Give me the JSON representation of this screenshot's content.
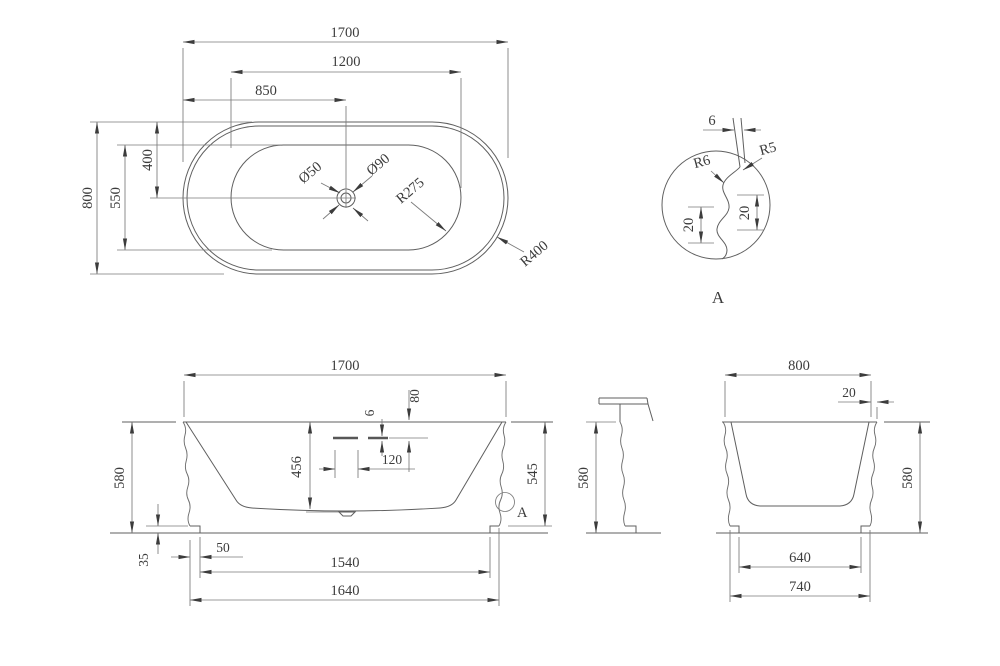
{
  "plan": {
    "length": "1700",
    "basin_length": "1200",
    "drain_offset_x": "850",
    "width": "800",
    "basin_width": "550",
    "drain_offset_y": "400",
    "drain_small": "Ø50",
    "drain_large": "Ø90",
    "basin_corner_radius": "R275",
    "corner_radius": "R400"
  },
  "detail": {
    "wall_thickness": "6",
    "lip_radius_outer": "R5",
    "lip_radius_inner": "R6",
    "depth_left": "20",
    "depth_right": "20",
    "label": "A"
  },
  "front": {
    "length": "1700",
    "overflow_drop": "80",
    "slot_height": "6",
    "slot_width": "120",
    "basin_depth": "456",
    "height": "580",
    "height_to_base": "545",
    "base_height": "35",
    "base_inset": "50",
    "base_inner": "1540",
    "base_outer": "1640",
    "detail_ref": "A"
  },
  "profile": {
    "height": "580"
  },
  "end": {
    "width": "800",
    "rim_lip": "20",
    "height": "580",
    "base_inner": "640",
    "base_outer": "740"
  }
}
